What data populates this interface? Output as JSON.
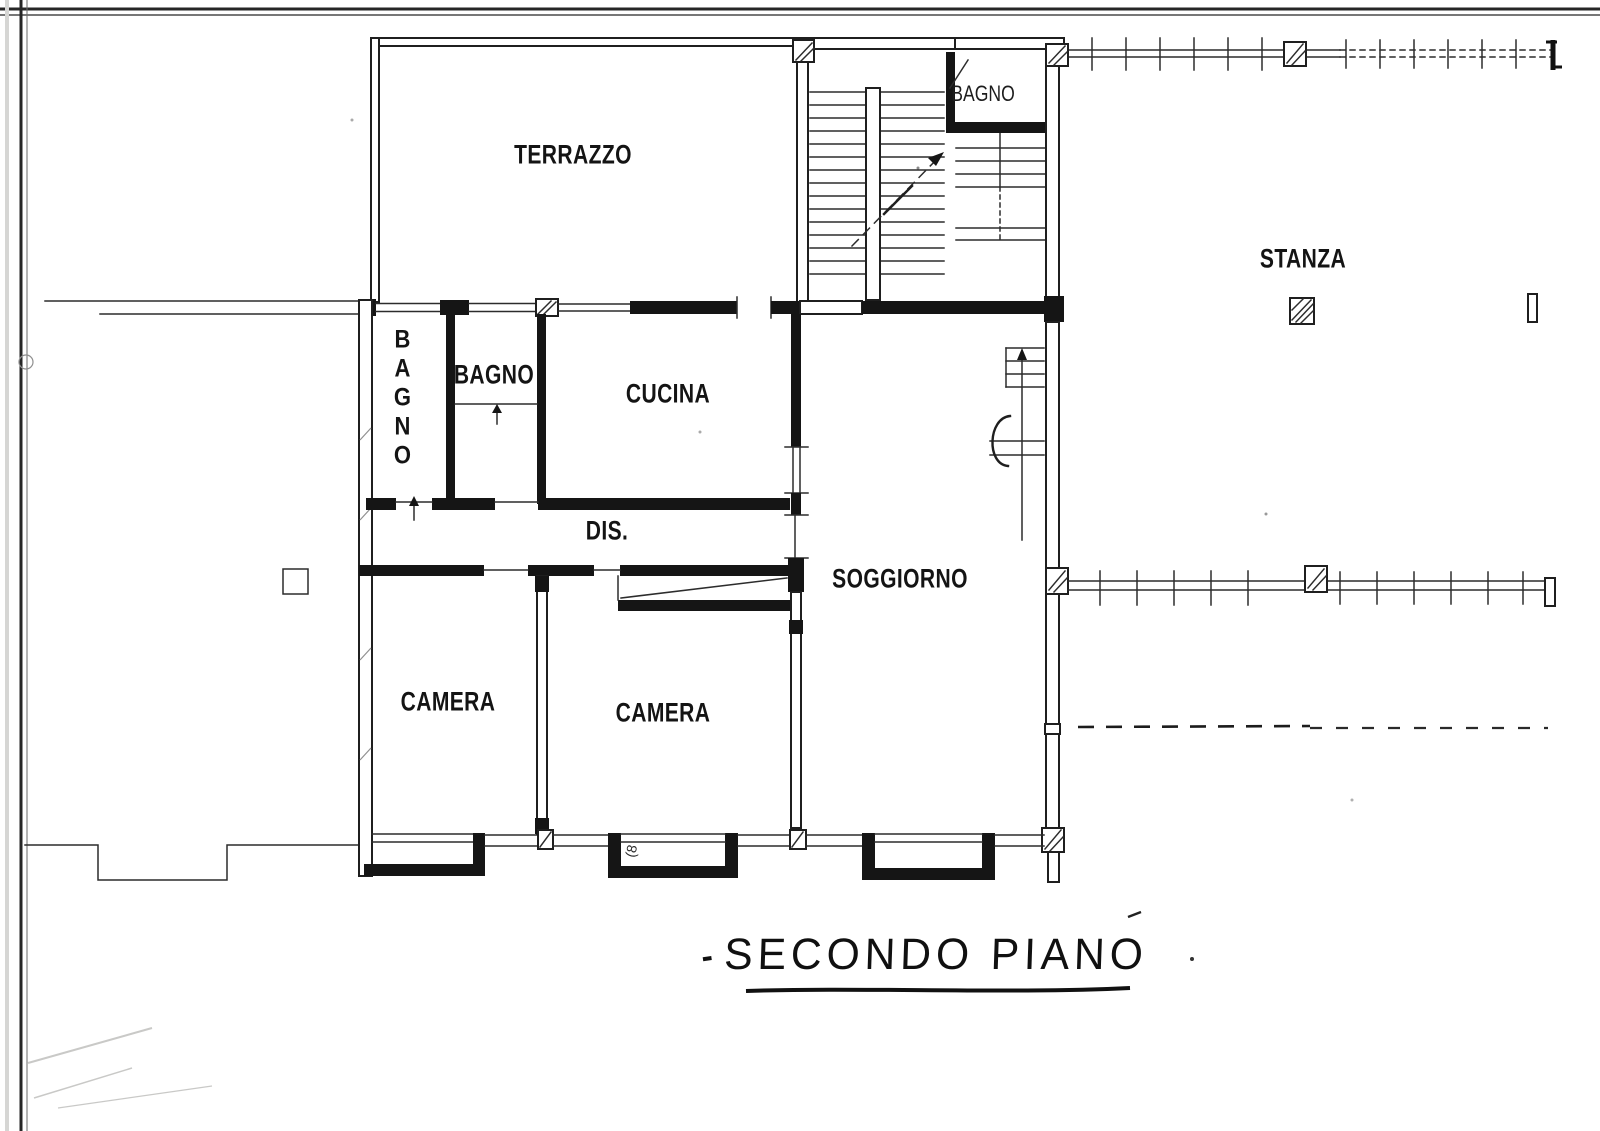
{
  "plan": {
    "rooms": {
      "terrazzo": "TERRAZZO",
      "bagno_stairwell": "BAGNO",
      "bagno_left": "BAGNO",
      "bagno_center": "BAGNO",
      "cucina": "CUCINA",
      "disimpegno": "DIS.",
      "soggiorno": "SOGGIORNO",
      "stanza": "STANZA",
      "camera_left": "CAMERA",
      "camera_center": "CAMERA"
    },
    "title": {
      "dash": "-",
      "text": "SECONDO PIANO"
    },
    "annotations": {
      "balcony_note": "(8"
    },
    "colors": {
      "ink": "#1c1c1c",
      "paper": "#ffffff"
    }
  }
}
